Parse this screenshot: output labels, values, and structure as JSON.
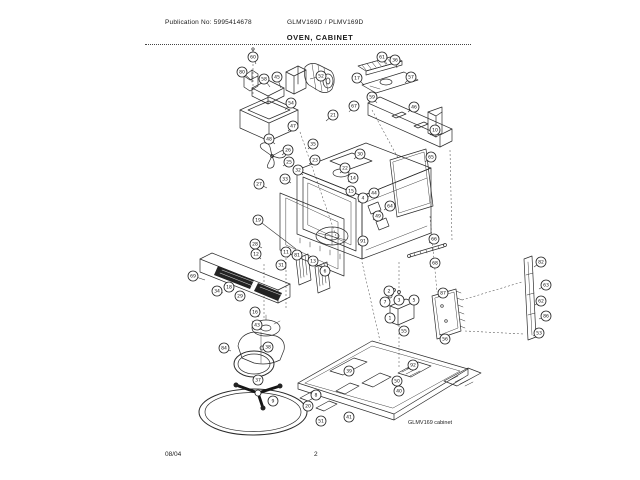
{
  "header": {
    "publication": "Publication No: 5995414678",
    "models": "GLMV169D / PLMV169D",
    "title": "OVEN, CABINET"
  },
  "footer": {
    "date": "08/04",
    "page": "2"
  },
  "diagram": {
    "caption": "GLMV169 cabinet",
    "callouts": [
      {
        "n": "80",
        "x": 242,
        "y": 72,
        "lx": 251,
        "ly": 80
      },
      {
        "n": "60",
        "x": 253,
        "y": 57,
        "lx": 256,
        "ly": 64
      },
      {
        "n": "58",
        "x": 264,
        "y": 79,
        "lx": 270,
        "ly": 87
      },
      {
        "n": "45",
        "x": 277,
        "y": 77,
        "lx": 281,
        "ly": 88
      },
      {
        "n": "52",
        "x": 321,
        "y": 76,
        "lx": 310,
        "ly": 79
      },
      {
        "n": "54",
        "x": 291,
        "y": 103,
        "lx": 285,
        "ly": 110
      },
      {
        "n": "47",
        "x": 293,
        "y": 126,
        "lx": 288,
        "ly": 131
      },
      {
        "n": "21",
        "x": 333,
        "y": 115,
        "lx": 326,
        "ly": 121
      },
      {
        "n": "67",
        "x": 354,
        "y": 106,
        "lx": 349,
        "ly": 112
      },
      {
        "n": "17",
        "x": 357,
        "y": 78,
        "lx": 364,
        "ly": 85
      },
      {
        "n": "61",
        "x": 382,
        "y": 57,
        "lx": 387,
        "ly": 64
      },
      {
        "n": "36",
        "x": 395,
        "y": 60,
        "lx": 397,
        "ly": 68
      },
      {
        "n": "57",
        "x": 411,
        "y": 77,
        "lx": 405,
        "ly": 83
      },
      {
        "n": "59",
        "x": 372,
        "y": 97,
        "lx": 377,
        "ly": 103
      },
      {
        "n": "46",
        "x": 414,
        "y": 107,
        "lx": 408,
        "ly": 112
      },
      {
        "n": "48",
        "x": 269,
        "y": 139,
        "lx": 275,
        "ly": 144
      },
      {
        "n": "10",
        "x": 435,
        "y": 130,
        "lx": 430,
        "ly": 135
      },
      {
        "n": "26",
        "x": 288,
        "y": 150,
        "lx": 282,
        "ly": 155
      },
      {
        "n": "25",
        "x": 289,
        "y": 162,
        "lx": 283,
        "ly": 166
      },
      {
        "n": "35",
        "x": 313,
        "y": 144,
        "lx": 308,
        "ly": 149
      },
      {
        "n": "23",
        "x": 315,
        "y": 160,
        "lx": 309,
        "ly": 164
      },
      {
        "n": "33",
        "x": 285,
        "y": 179,
        "lx": 291,
        "ly": 183
      },
      {
        "n": "32",
        "x": 298,
        "y": 170,
        "lx": 303,
        "ly": 175
      },
      {
        "n": "27",
        "x": 259,
        "y": 184,
        "lx": 267,
        "ly": 188
      },
      {
        "n": "19",
        "x": 258,
        "y": 220,
        "lx": 296,
        "ly": 249
      },
      {
        "n": "28",
        "x": 255,
        "y": 244,
        "lx": 262,
        "ly": 248
      },
      {
        "n": "30",
        "x": 360,
        "y": 154,
        "lx": 354,
        "ly": 159
      },
      {
        "n": "22",
        "x": 345,
        "y": 168,
        "lx": 340,
        "ly": 173
      },
      {
        "n": "14",
        "x": 353,
        "y": 178,
        "lx": 348,
        "ly": 182
      },
      {
        "n": "15",
        "x": 351,
        "y": 191,
        "lx": 347,
        "ly": 194
      },
      {
        "n": "4",
        "x": 363,
        "y": 198,
        "lx": 358,
        "ly": 202
      },
      {
        "n": "44",
        "x": 374,
        "y": 193,
        "lx": 368,
        "ly": 197
      },
      {
        "n": "64",
        "x": 390,
        "y": 206,
        "lx": 384,
        "ly": 210
      },
      {
        "n": "49",
        "x": 378,
        "y": 216,
        "lx": 373,
        "ly": 220
      },
      {
        "n": "91",
        "x": 363,
        "y": 241,
        "lx": 358,
        "ly": 245
      },
      {
        "n": "69",
        "x": 193,
        "y": 276,
        "lx": 205,
        "ly": 280
      },
      {
        "n": "34",
        "x": 217,
        "y": 291,
        "lx": 223,
        "ly": 293
      },
      {
        "n": "18",
        "x": 229,
        "y": 287,
        "lx": 234,
        "ly": 290
      },
      {
        "n": "29",
        "x": 240,
        "y": 296,
        "lx": 245,
        "ly": 298
      },
      {
        "n": "12",
        "x": 256,
        "y": 254,
        "lx": 261,
        "ly": 259
      },
      {
        "n": "31",
        "x": 281,
        "y": 265,
        "lx": 286,
        "ly": 269
      },
      {
        "n": "11",
        "x": 286,
        "y": 252,
        "lx": 288,
        "ly": 258
      },
      {
        "n": "81",
        "x": 297,
        "y": 255,
        "lx": 299,
        "ly": 260
      },
      {
        "n": "13",
        "x": 313,
        "y": 261,
        "lx": 315,
        "ly": 266
      },
      {
        "n": "6",
        "x": 325,
        "y": 271,
        "lx": 327,
        "ly": 275
      },
      {
        "n": "16",
        "x": 255,
        "y": 312,
        "lx": 259,
        "ly": 317
      },
      {
        "n": "43",
        "x": 257,
        "y": 325,
        "lx": 261,
        "ly": 330
      },
      {
        "n": "38",
        "x": 268,
        "y": 347,
        "lx": 272,
        "ly": 351
      },
      {
        "n": "84",
        "x": 224,
        "y": 348,
        "lx": 231,
        "ly": 351
      },
      {
        "n": "37",
        "x": 258,
        "y": 380,
        "lx": 261,
        "ly": 385
      },
      {
        "n": "9",
        "x": 273,
        "y": 401,
        "lx": 278,
        "ly": 403
      },
      {
        "n": "8",
        "x": 316,
        "y": 395,
        "lx": 320,
        "ly": 397
      },
      {
        "n": "20",
        "x": 308,
        "y": 406,
        "lx": 313,
        "ly": 407
      },
      {
        "n": "51",
        "x": 321,
        "y": 421,
        "lx": 326,
        "ly": 422
      },
      {
        "n": "41",
        "x": 349,
        "y": 417,
        "lx": 353,
        "ly": 418
      },
      {
        "n": "39",
        "x": 349,
        "y": 371,
        "lx": 353,
        "ly": 374
      },
      {
        "n": "92",
        "x": 413,
        "y": 365,
        "lx": 407,
        "ly": 369
      },
      {
        "n": "50",
        "x": 397,
        "y": 381,
        "lx": 392,
        "ly": 384
      },
      {
        "n": "40",
        "x": 399,
        "y": 391,
        "lx": 394,
        "ly": 393
      },
      {
        "n": "2",
        "x": 389,
        "y": 291,
        "lx": 393,
        "ly": 295
      },
      {
        "n": "3",
        "x": 399,
        "y": 300,
        "lx": 402,
        "ly": 303
      },
      {
        "n": "5",
        "x": 414,
        "y": 300,
        "lx": 410,
        "ly": 304
      },
      {
        "n": "7",
        "x": 385,
        "y": 302,
        "lx": 390,
        "ly": 306
      },
      {
        "n": "1",
        "x": 390,
        "y": 318,
        "lx": 394,
        "ly": 320
      },
      {
        "n": "55",
        "x": 404,
        "y": 331,
        "lx": 406,
        "ly": 327
      },
      {
        "n": "65",
        "x": 431,
        "y": 157,
        "lx": 425,
        "ly": 162
      },
      {
        "n": "66",
        "x": 434,
        "y": 239,
        "lx": 429,
        "ly": 243
      },
      {
        "n": "68",
        "x": 435,
        "y": 263,
        "lx": 430,
        "ly": 267
      },
      {
        "n": "87",
        "x": 443,
        "y": 293,
        "lx": 438,
        "ly": 297
      },
      {
        "n": "56",
        "x": 445,
        "y": 339,
        "lx": 440,
        "ly": 334
      },
      {
        "n": "82",
        "x": 541,
        "y": 262,
        "lx": 534,
        "ly": 267
      },
      {
        "n": "63",
        "x": 546,
        "y": 285,
        "lx": 539,
        "ly": 289
      },
      {
        "n": "62",
        "x": 541,
        "y": 301,
        "lx": 535,
        "ly": 305
      },
      {
        "n": "86",
        "x": 546,
        "y": 316,
        "lx": 539,
        "ly": 319
      },
      {
        "n": "53",
        "x": 539,
        "y": 333,
        "lx": 533,
        "ly": 336
      }
    ]
  }
}
